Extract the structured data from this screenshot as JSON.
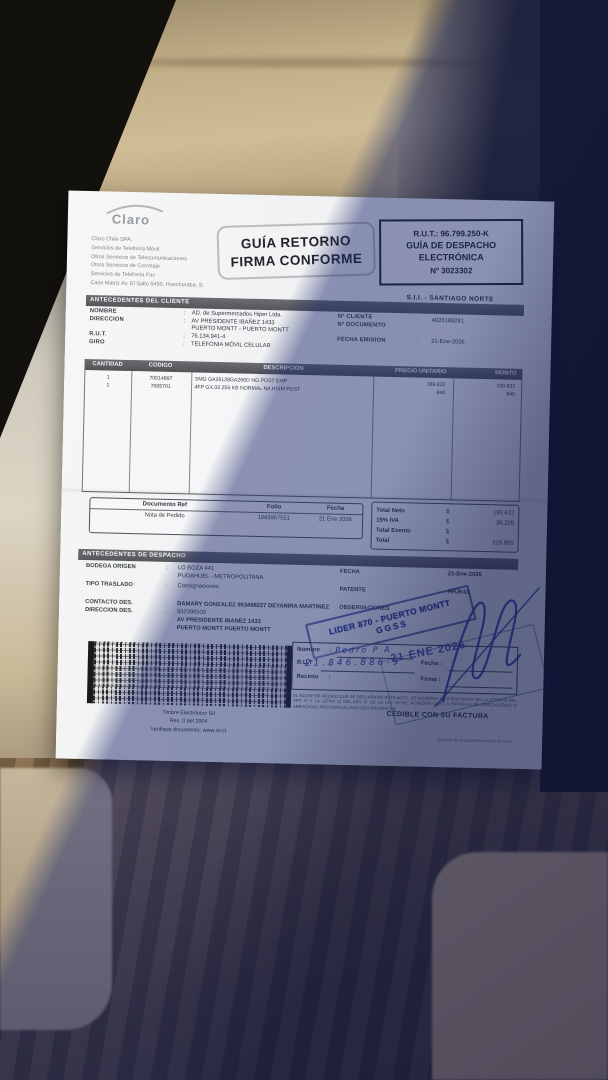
{
  "punct": {
    "colon": ":"
  },
  "colors": {
    "pen_blue": "#2b3fa8",
    "stamp_blue": "#27368f",
    "paper": "#f1f2f4",
    "shadow": "rgba(24,38,105,0.48)"
  },
  "document": {
    "brand": "Claro",
    "company_lines": [
      "Claro Chile SPA.",
      "Servicios de Telefonía Móvil",
      "Otros Servicios de Telecomunicaciones",
      "Otros Servicios de Corretaje",
      "Servicios de Telefonía Fax",
      "Casa Matriz Av. El Salto 5450, Huechuraba, S."
    ],
    "return_stamp": {
      "line1": "GUÍA RETORNO",
      "line2": "FIRMA CONFORME"
    },
    "rut_box": {
      "rut": "R.U.T.: 96.799.250-K",
      "doc_type_line1": "GUÍA DE DESPACHO",
      "doc_type_line2": "ELECTRÓNICA",
      "number": "Nº 3023302"
    },
    "sii_office": "S.I.I. - SANTIAGO NORTE",
    "client": {
      "title": "ANTECEDENTES DEL CLIENTE",
      "nombre_label": "NOMBRE",
      "nombre": "AD. de Supermercados Hiper Ltda.",
      "direccion_label": "DIRECCION",
      "direccion1": "AV PRESIDENTE IBAÑEZ 1433",
      "direccion2": "PUERTO MONTT -  PUERTO MONTT",
      "rut_label": "R.U.T.",
      "rut": "76.134.941-4",
      "giro_label": "GIRO",
      "giro": "TELEFONIA MÓVIL CELULAR",
      "cliente_num_label": "Nº CLIENTE",
      "cliente_num": "4026189281",
      "documento_num_label": "Nº DOCUMENTO",
      "fecha_emision_label": "FECHA EMISION",
      "fecha_emision": "21-Ene-2026"
    },
    "items": {
      "headers": {
        "cantidad": "CANTIDAD",
        "codigo": "CODIGO",
        "descripcion": "DESCRIPCION",
        "precio": "PRECIO UNITARIO",
        "monto": "MONTO"
      },
      "rows": [
        {
          "cantidad": "1",
          "codigo": "70014897",
          "descripcion": "SMG GA26128GA266D NG POST EMP",
          "precio": "189.832",
          "monto": "189.832"
        },
        {
          "cantidad": "1",
          "codigo": "7005701",
          "descripcion": "4FP GX.02 256 KB NORMAL NA HSIM POST",
          "precio": "840",
          "monto": "840"
        }
      ]
    },
    "ref_table": {
      "headers": [
        "Documento Ref",
        "Folio",
        "Fecha"
      ],
      "row": [
        "Nota de Pedido",
        "1083967551",
        "21 Ene 2026"
      ]
    },
    "totals": {
      "rows": [
        {
          "label": "Total Neto",
          "sign": "$",
          "value": "190.672"
        },
        {
          "label": "19% IVA",
          "sign": "$",
          "value": "36.228"
        },
        {
          "label": "Total Exento",
          "sign": "$",
          "value": ""
        },
        {
          "label": "Total",
          "sign": "$",
          "value": "226.900"
        }
      ]
    },
    "dispatch": {
      "title": "ANTECEDENTES DE DESPACHO",
      "bodega_label": "BODEGA ORIGEN",
      "bodega1": "LO BOZA 441",
      "bodega2": "PUDAHUEL - METROPOLITANA",
      "traslado_label": "TIPO TRASLADO",
      "traslado": "Consignaciones",
      "contacto_label": "CONTACTO DES.",
      "contacto": "DAMARY GONZALEZ 953498227 DEYANIRA MARTINEZ",
      "direccion_label": "DIRECCION DES.",
      "direccion1": "932398500",
      "direccion2": "AV PRESIDENTE IBANEZ 1433",
      "direccion3": "PUERTO MONTT  PUERTO MONTT",
      "fecha_label": "FECHA",
      "fecha": "21-Ene-2026",
      "patente_label": "PATENTE",
      "patente": "HHJK63",
      "observaciones_label": "OBSERVACIONES"
    },
    "lider_stamp": {
      "line1": "LIDER 870 - PUERTO MONTT",
      "line2": "GGSS"
    },
    "signature_box": {
      "nombre_label": "Nombre",
      "rut_label": "R.U.T",
      "recinto_label": "Recinto",
      "fecha_label": "Fecha :",
      "firma_label": "Firma :",
      "nombre_handwritten": "Pedro P A",
      "rut_handwritten": "21.846.886-9"
    },
    "date_stamp": "21 ENE 2026",
    "fine_print": "EL ACUSE DE RECIBO QUE SE DECLARA EN ESTE ACTO, DE ACUERDO A LO DISPUESTO EN LA LETRA B) DEL ART. 4° Y LA LETRA C) DEL ART. 5° DE LA LEY 19.983, ACREDITA QUE LA ENTREGA DE MERCADERIAS O SERVICIO(S) PRESTADO(S) HAN SIDO RECIBIDO(S).",
    "cedible": "CEDIBLE CON SU FACTURA",
    "timbre": {
      "line1": "Timbre Electrónico SII",
      "line2": "Res. 0 del 2004",
      "line3": "Verifique documento: www.sii.cl"
    },
    "footer_right": "Solución de Factura Electrónica de www…"
  }
}
